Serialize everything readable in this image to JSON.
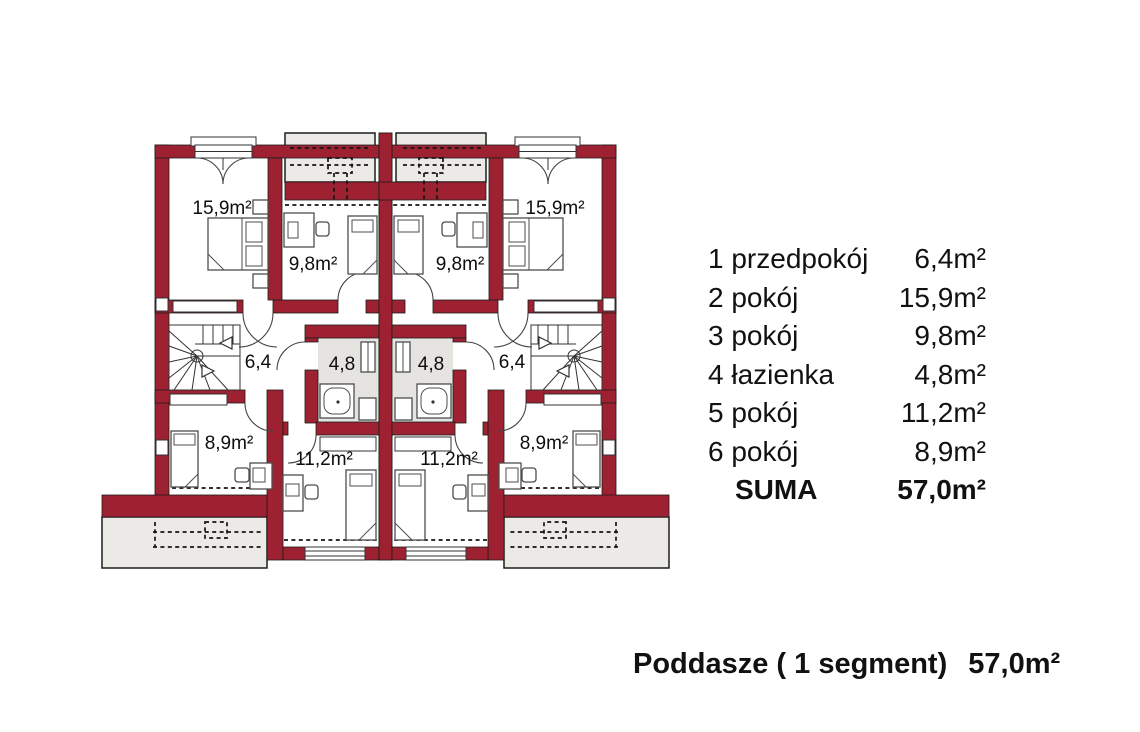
{
  "colors": {
    "wall": "#9d2130",
    "balcony": "#eceae6",
    "bath": "#e6e4e0"
  },
  "plan": {
    "left": {
      "room2": "15,9m²",
      "room3": "9,8m²",
      "hall": "6,4",
      "bath": "4,8",
      "room6": "8,9m²",
      "room5": "11,2m²"
    },
    "right": {
      "room2": "15,9m²",
      "room3": "9,8m²",
      "hall": "6,4",
      "bath": "4,8",
      "room6": "8,9m²",
      "room5": "11,2m²"
    }
  },
  "legend": {
    "rows": [
      {
        "label": "1 przedpokój",
        "area": "6,4m²"
      },
      {
        "label": "2 pokój",
        "area": "15,9m²"
      },
      {
        "label": "3 pokój",
        "area": "9,8m²"
      },
      {
        "label": "4 łazienka",
        "area": "4,8m²"
      },
      {
        "label": "5 pokój",
        "area": "11,2m²"
      },
      {
        "label": "6 pokój",
        "area": "8,9m²"
      }
    ],
    "total_label": "SUMA",
    "total_area": "57,0m²"
  },
  "footer": {
    "title": "Poddasze ( 1 segment)",
    "area": "57,0m²"
  }
}
